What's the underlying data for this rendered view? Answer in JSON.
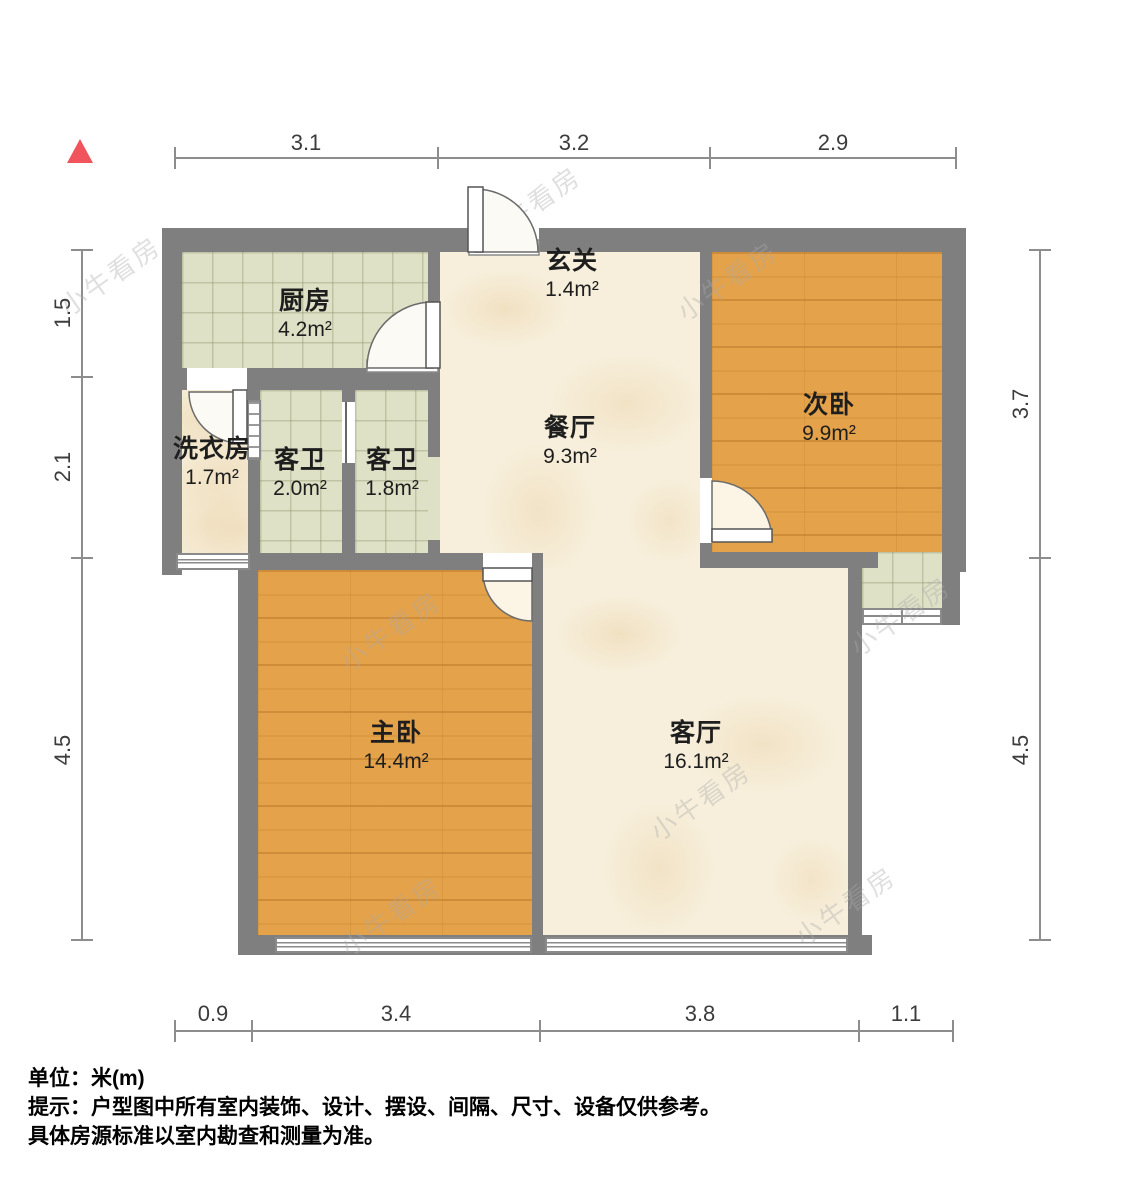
{
  "compass": {
    "shape": "north-triangle",
    "color": "#f0545c"
  },
  "watermark": {
    "text": "小牛看房"
  },
  "rooms": {
    "kitchen": {
      "name": "厨房",
      "area": "4.2m²"
    },
    "entry": {
      "name": "玄关",
      "area": "1.4m²"
    },
    "dining": {
      "name": "餐厅",
      "area": "9.3m²"
    },
    "second_bedroom": {
      "name": "次卧",
      "area": "9.9m²"
    },
    "laundry": {
      "name": "洗衣房",
      "area": "1.7m²"
    },
    "bath1": {
      "name": "客卫",
      "area": "2.0m²"
    },
    "bath2": {
      "name": "客卫",
      "area": "1.8m²"
    },
    "master_bedroom": {
      "name": "主卧",
      "area": "14.4m²"
    },
    "living": {
      "name": "客厅",
      "area": "16.1m²"
    }
  },
  "dims": {
    "top": [
      "3.1",
      "3.2",
      "2.9"
    ],
    "bottom": [
      "0.9",
      "3.4",
      "3.8",
      "1.1"
    ],
    "left": [
      "1.5",
      "2.1",
      "4.5"
    ],
    "right": [
      "3.7",
      "4.5"
    ]
  },
  "footer": {
    "unit": "单位：米(m)",
    "tip": "提示：户型图中所有室内装饰、设计、摆设、间隔、尺寸、设备仅供参考。",
    "note": "具体房源标准以室内勘查和测量为准。"
  },
  "colors": {
    "wall": "#7f7f7f",
    "wood_floor": "#e4a24a",
    "tile_floor": "#dfe1c6",
    "marble_floor": "#f7efdb",
    "accent": "#f0545c"
  }
}
